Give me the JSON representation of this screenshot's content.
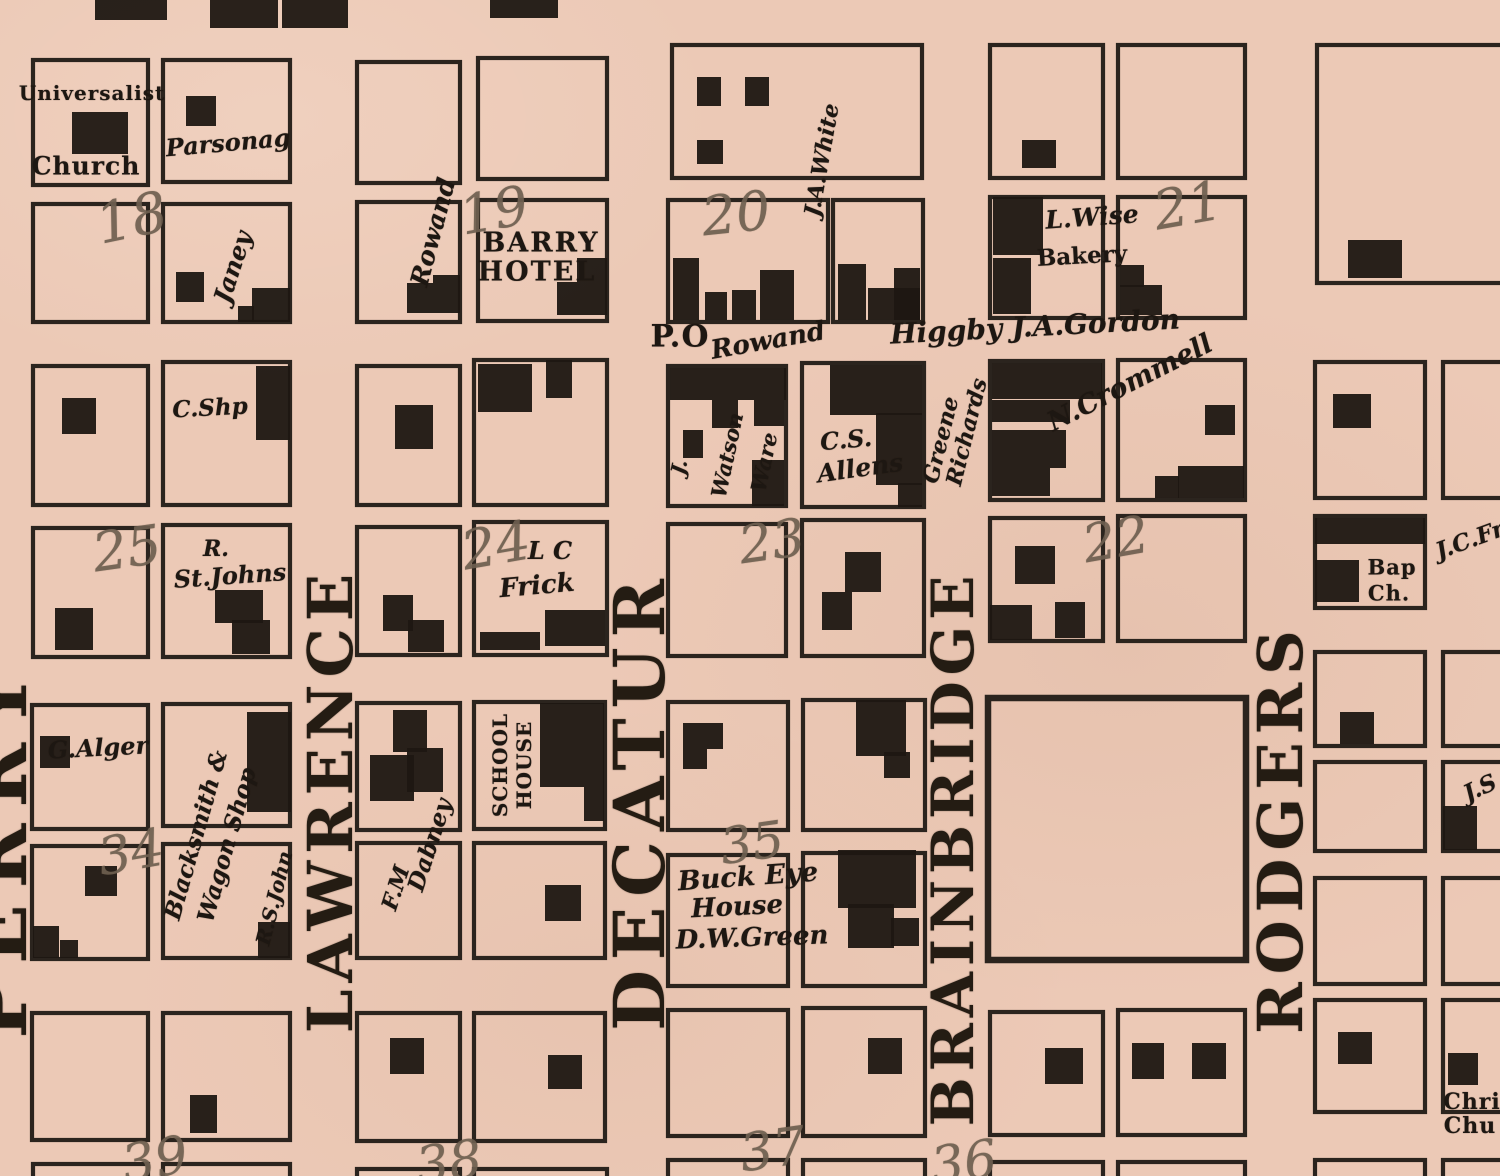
{
  "map": {
    "paper_color": "#ecc9b6",
    "ink_color": "#1d1712",
    "number_color": "#6e5f50",
    "streets": {
      "perry": "PERRY",
      "lawrence": "LAWRENCE",
      "decatur": "DECATUR",
      "brainbridge": "BRAINBRIDGE",
      "rodgers": "RODGERS"
    },
    "numbers": {
      "n18": "18",
      "n19": "19",
      "n20": "20",
      "n21": "21",
      "n25": "25",
      "n24": "24",
      "n23": "23",
      "n22": "22",
      "n34": "34",
      "n35": "35",
      "n39": "39",
      "n38": "38",
      "n37": "37",
      "n36": "36"
    },
    "labels": {
      "universalist": "Universalist",
      "church": "Church",
      "parsonage": "Parsonag",
      "janey": "Janey",
      "rowand_vertical": "Rowand",
      "barry": "BARRY",
      "hotel": "HOTEL",
      "ja_white": "J.A.White",
      "l_wise": "L.Wise",
      "bakery": "Bakery",
      "po": "P.O",
      "rowand": "Rowand",
      "higgby_gordon": "Higgby J.A.Gordon",
      "c_shp": "C.Shp",
      "j": "J.",
      "watson": "Watson",
      "ware": "Ware",
      "cs": "C.S.",
      "allens": "Allens",
      "greene": "Greene",
      "richards": "Richards",
      "n_crommell": "N.Crommell",
      "r": "R.",
      "st_johns": "St.Johns",
      "lc": "L C",
      "frick": "Frick",
      "bap": "Bap",
      "ch": "Ch.",
      "jc_fr": "J.C.Fr",
      "g_alger": "G.Alger",
      "blacksmith": "Blacksmith &",
      "wagon_shop": "Wagon Shop",
      "rs_john": "R.S.John",
      "fm": "F.M",
      "dabney": "Dabney",
      "school": "SCHOOL",
      "house": "HOUSE",
      "buck_eye": "Buck Eye",
      "buck_eye_house": "House",
      "dw_green": "D.W.Green",
      "js": "J.S",
      "chri": "Chri",
      "chu": "Chu"
    }
  }
}
